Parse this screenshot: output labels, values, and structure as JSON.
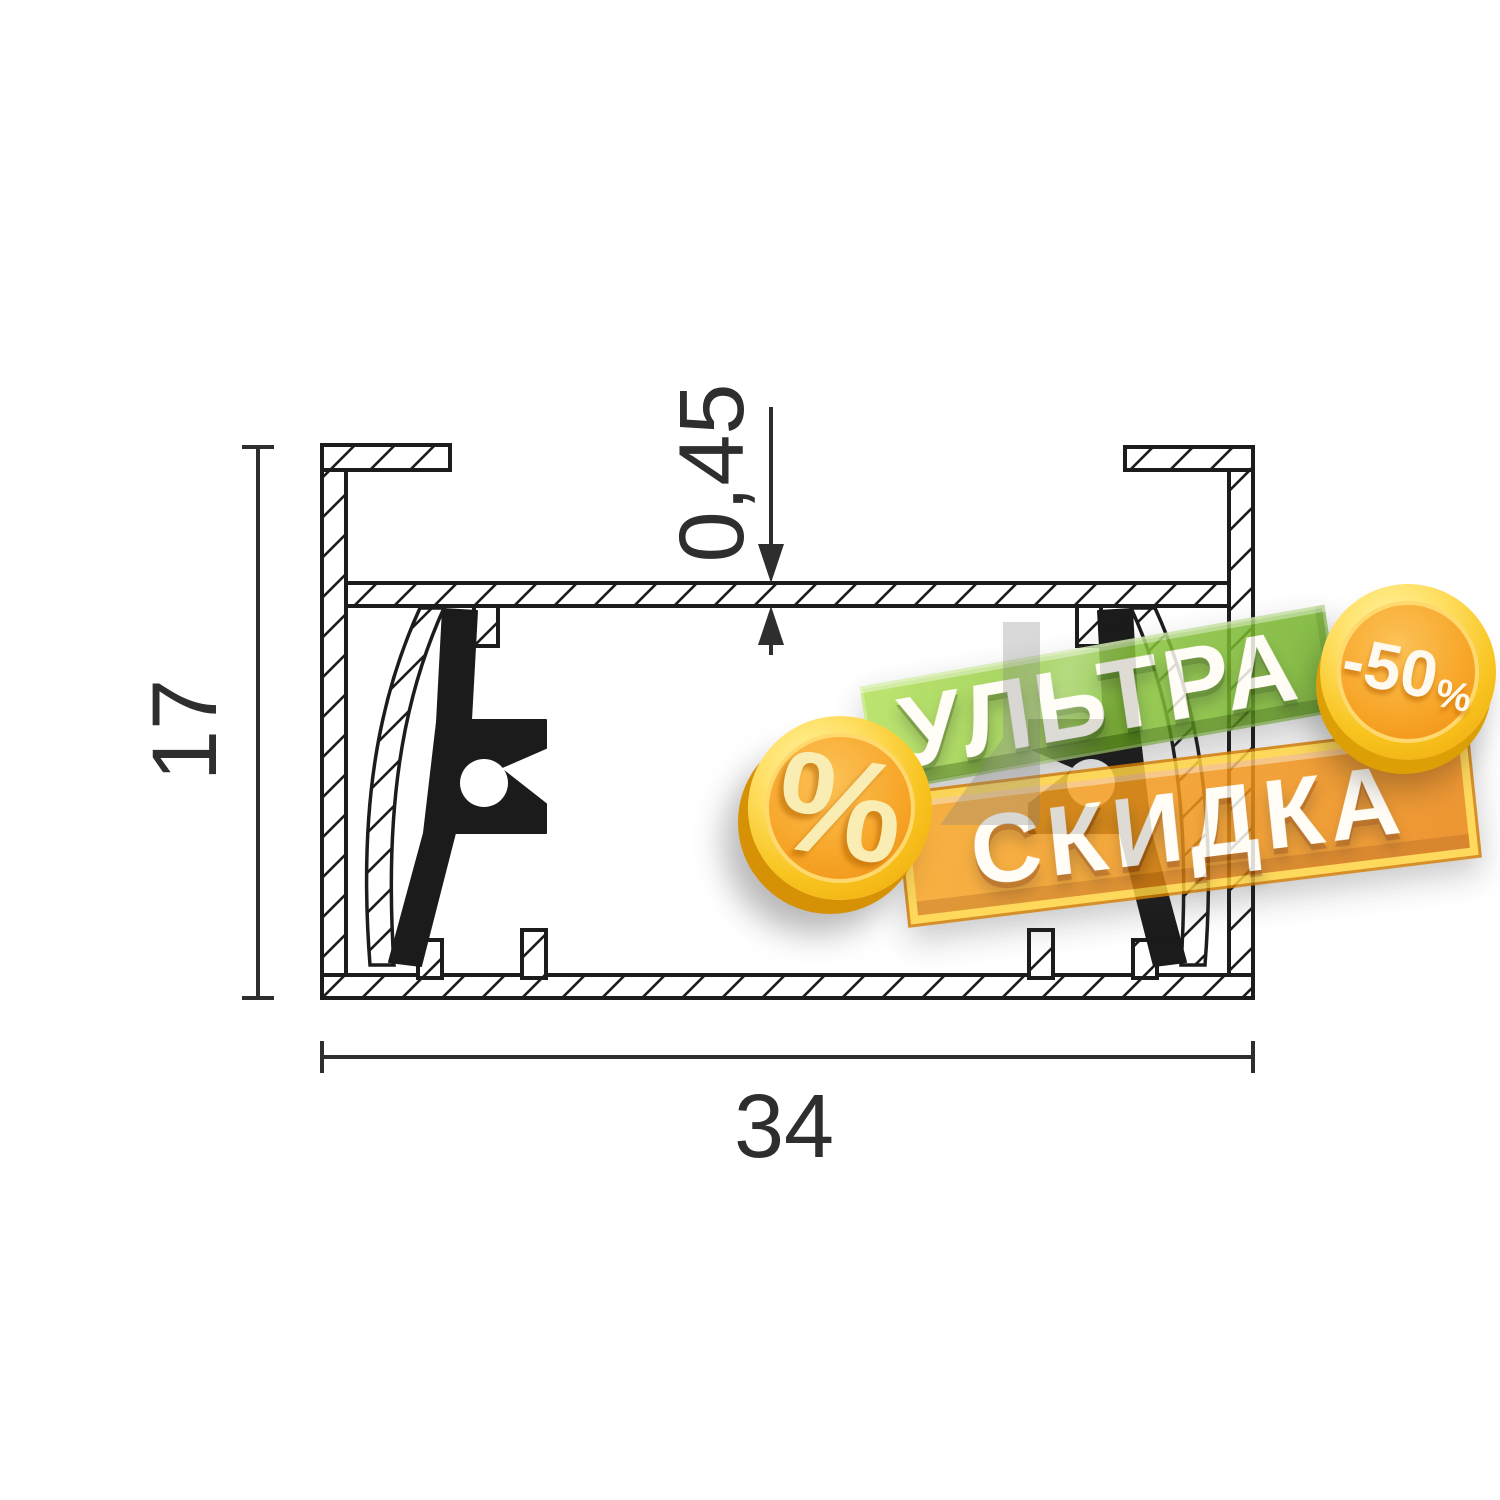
{
  "drawing": {
    "title": "aluminum profile cross-section",
    "dim_height": "17",
    "dim_width": "34",
    "dim_wall_thickness": "0,45",
    "line_color": "#1c1c1c",
    "dim_color": "#2e2e2e"
  },
  "sticker": {
    "banner_top": {
      "label": "УЛЬТРА",
      "face_color": "#8cc63e",
      "edge_color": "#4a7f12"
    },
    "banner_bottom": {
      "label": "СКИДКА",
      "face_color": "#f1951a",
      "rim_color": "#ffd340"
    },
    "coin_left": {
      "symbol": "%",
      "gold_color": "#f8c41f",
      "face_color": "#f7a629"
    },
    "coin_right": {
      "value": "-50",
      "suffix": "%",
      "gold_color": "#f8c41f",
      "face_color": "#f7a629"
    }
  }
}
